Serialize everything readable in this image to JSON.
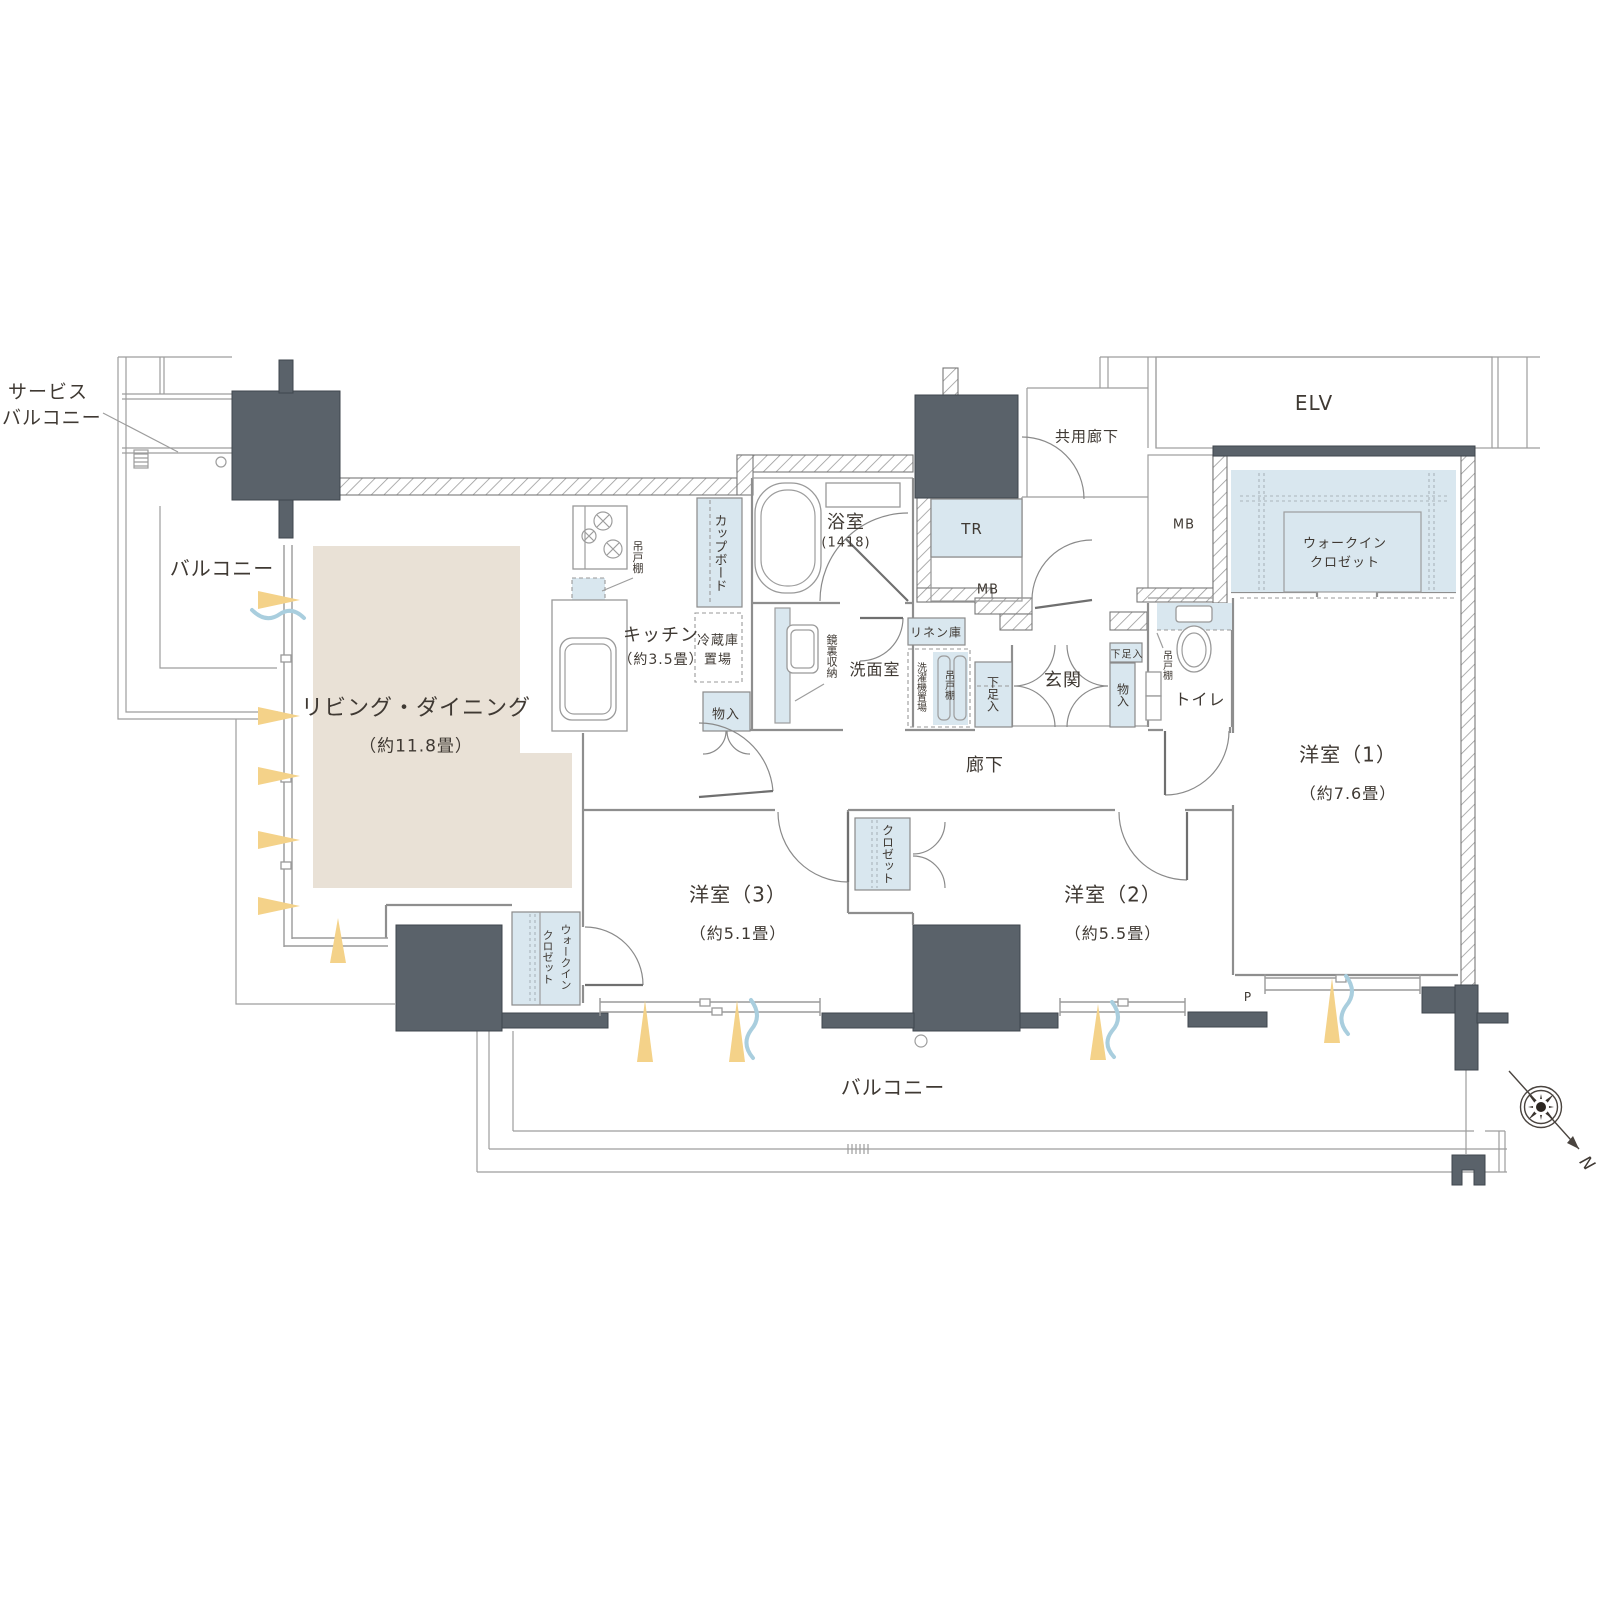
{
  "colors": {
    "floor_beige": "#e9e1d6",
    "storage_blue": "#d9e7ef",
    "pillar_gray": "#5a626a",
    "wall_line": "#8e8e8e",
    "text": "#3f3933",
    "light_yellow": "#f4d289",
    "wave_blue": "#a9cede"
  },
  "labels": {
    "service_balcony": {
      "line1": "サービス",
      "line2": "バルコニー"
    },
    "balcony_left": "バルコニー",
    "balcony_bottom": "バルコニー",
    "common_corridor": "共用廊下",
    "elv": "ELV",
    "tr": "TR",
    "mb_center": "MB",
    "mb_right": "MB",
    "pipe": "P",
    "north": "N",
    "living": {
      "name": "リビング・ダイニング",
      "size": "（約11.8畳）"
    },
    "kitchen": {
      "name": "キッチン",
      "size": "（約3.5畳）"
    },
    "bath": {
      "name": "浴室",
      "size": "(1418)"
    },
    "washroom": "洗面室",
    "toilet": "トイレ",
    "entrance": "玄関",
    "corridor": "廊下",
    "bedroom1": {
      "name": "洋室（1）",
      "size": "（約7.6畳）"
    },
    "bedroom2": {
      "name": "洋室（2）",
      "size": "（約5.5畳）"
    },
    "bedroom3": {
      "name": "洋室（3）",
      "size": "（約5.1畳）"
    },
    "wic_main": {
      "line1": "ウォークイン",
      "line2": "クロゼット"
    },
    "wic_b3": {
      "line1": "ウォークイン",
      "line2": "クロゼット"
    },
    "closet": "クロゼット",
    "cupboard": "カップボード",
    "fridge": {
      "line1": "冷蔵庫",
      "line2": "置場"
    },
    "hanging_kitchen": "吊戸棚",
    "hanging_wash": "吊戸棚",
    "hanging_toilet": "吊戸棚",
    "linen": "リネン庫",
    "washer": "洗濯機置場",
    "mirror": "鏡裏収納",
    "shoe_hall": "下足入",
    "shoe_entrance": "下足入",
    "storage_kitchen": "物入",
    "storage_entrance": "物入"
  }
}
